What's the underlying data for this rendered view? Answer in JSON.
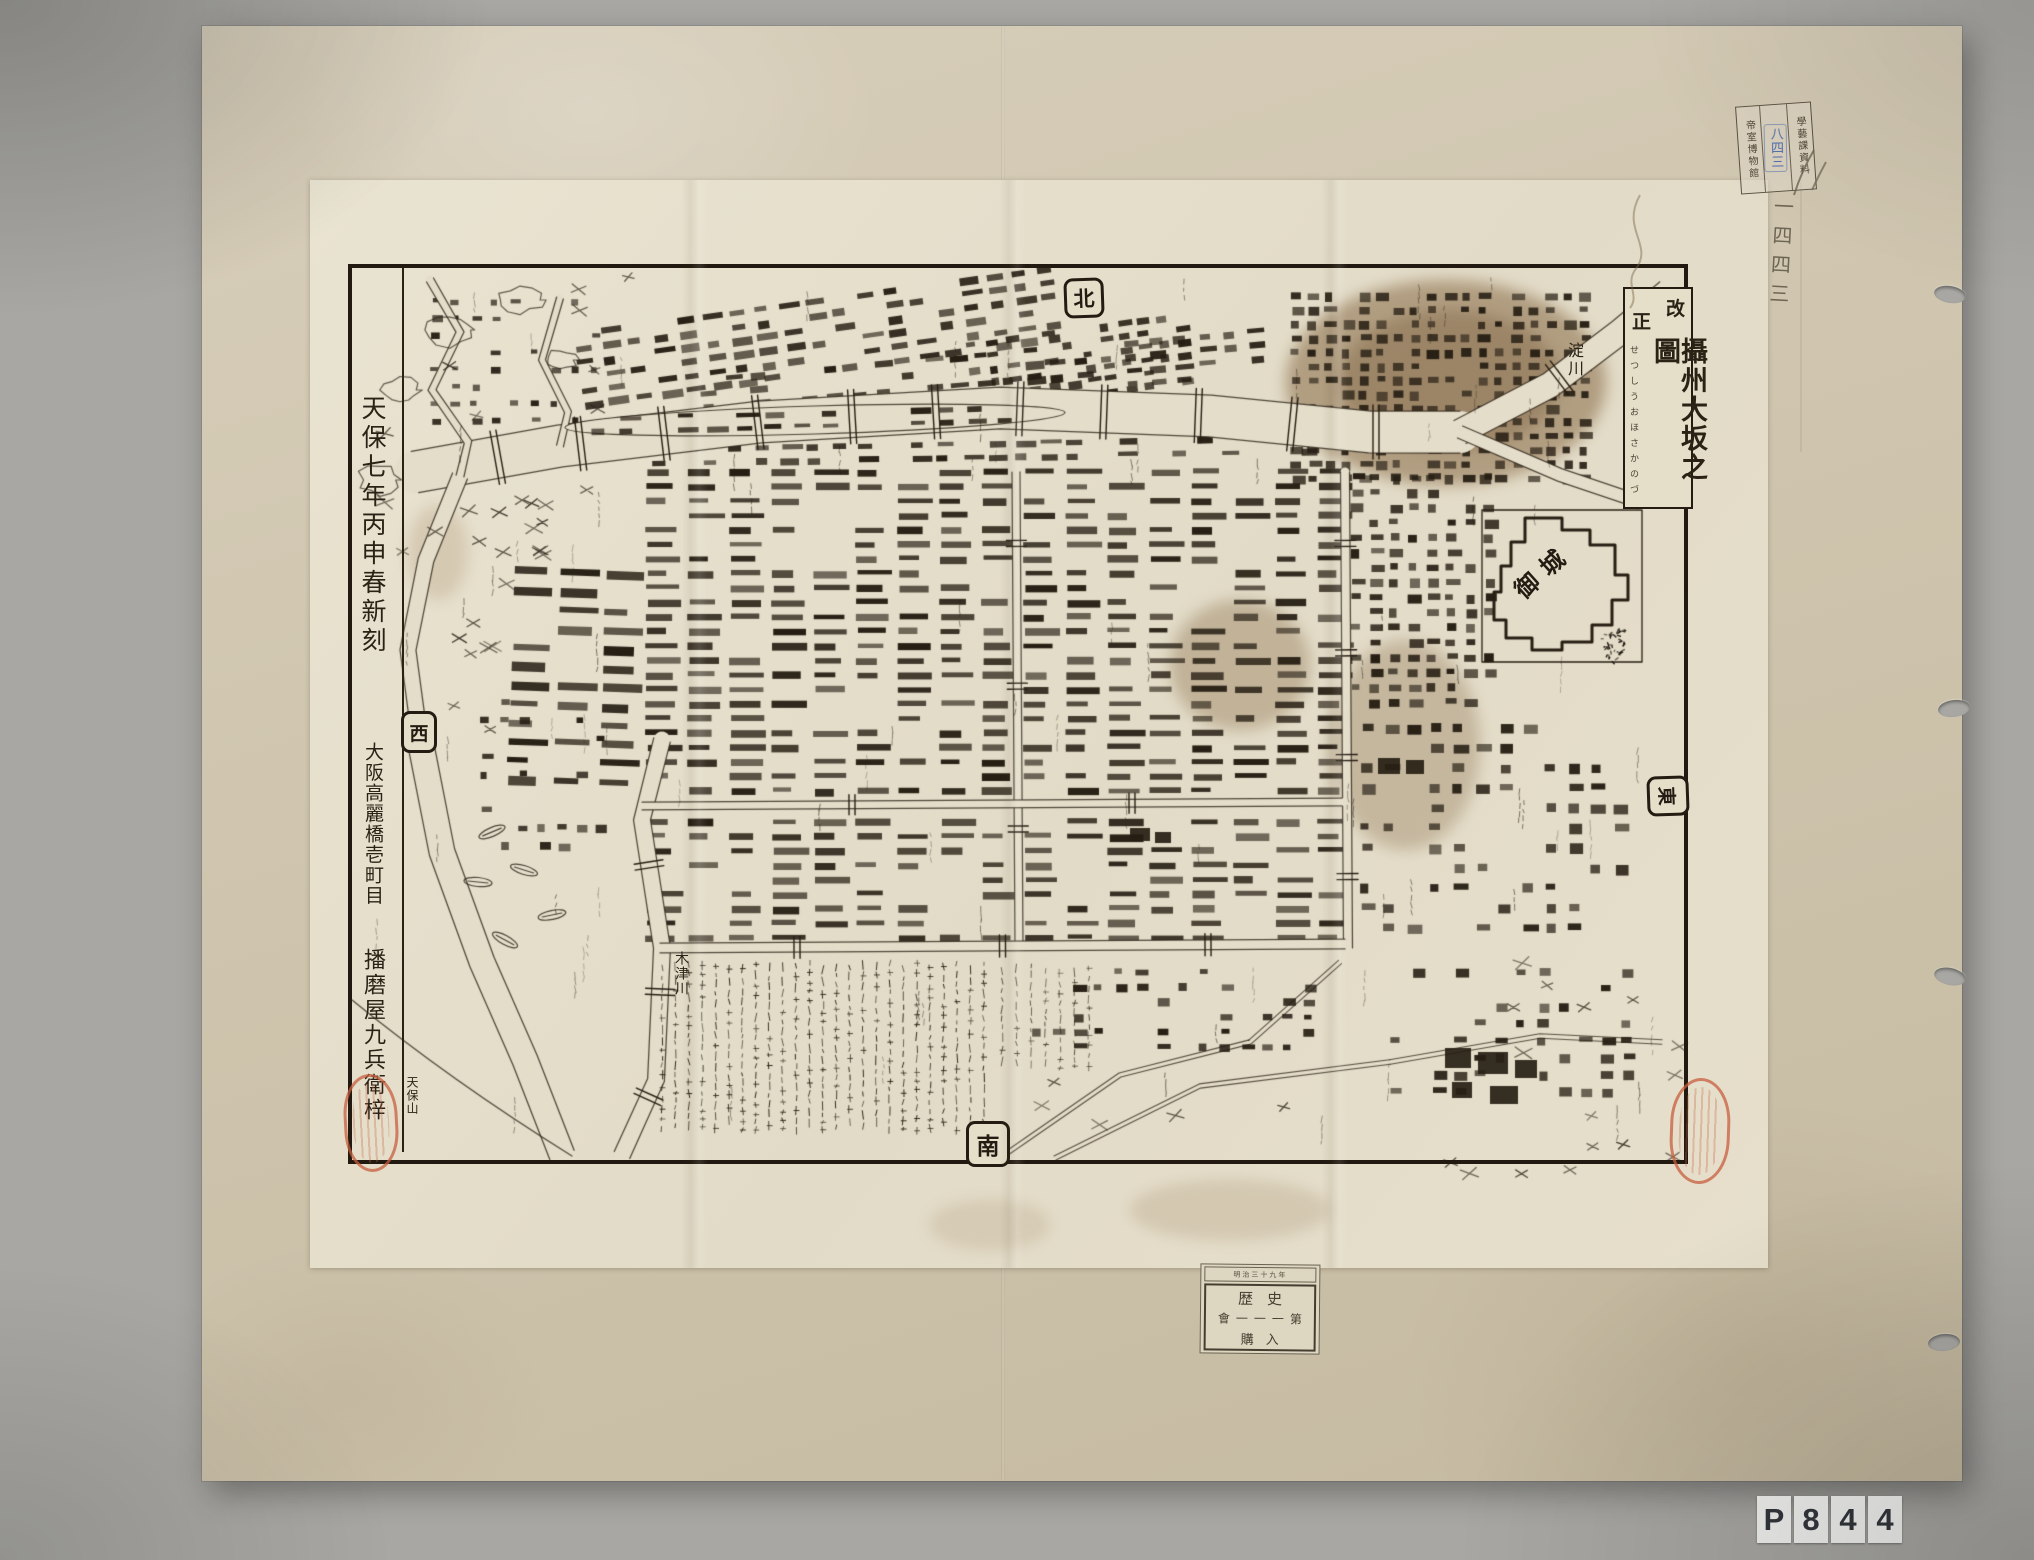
{
  "scan": {
    "bg_color": "#a8a7a3",
    "plate": [
      "P",
      "8",
      "4",
      "4"
    ]
  },
  "map": {
    "title": {
      "header": "改正",
      "main": "攝州大坂之圖",
      "furigana": "せつしうおほさかのづ"
    },
    "colophon": {
      "date": "天保七年丙申春新刻",
      "address": "大阪高麗橋壱町目",
      "publisher": "播磨屋九兵衛梓"
    },
    "directions": {
      "north": "北",
      "south": "南",
      "east": "東",
      "west": "西"
    },
    "labels": {
      "castle": "御城",
      "yodo_river": "淀川",
      "kizu_river": "木津川",
      "tenpozan": "天保山"
    }
  },
  "stamps": {
    "museum": {
      "right": "學藝課資料",
      "left": "帝室博物館",
      "blue": "八四三"
    },
    "pencil": "一四四三",
    "accession": {
      "strip": "明治三十九年",
      "row1": "歴史",
      "row2": "會一一一第",
      "row3": "購入"
    }
  }
}
